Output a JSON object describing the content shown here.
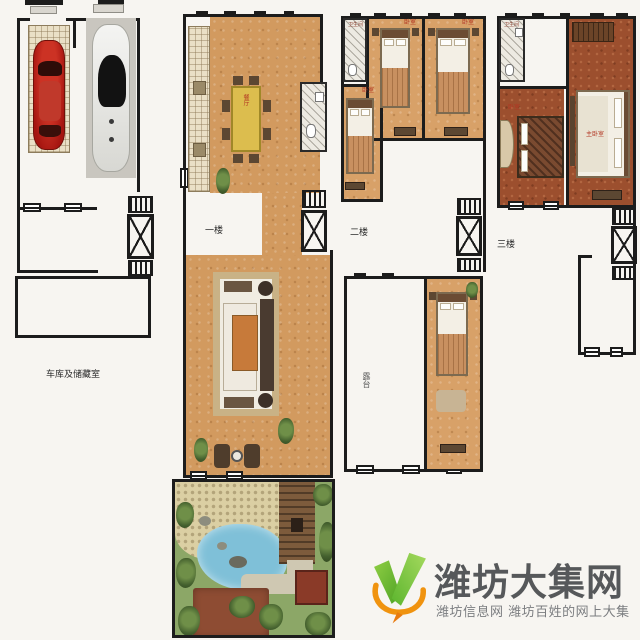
{
  "image_type": "multi-level villa floor plan (garage, 3 floors, garden) with site watermark",
  "plans": {
    "garage": {
      "name_label": "车库及储藏室"
    },
    "floor1": {
      "floor_label": "一楼",
      "dining_label": "餐厅"
    },
    "floor2": {
      "floor_label": "二楼",
      "bath_label": "卫生间",
      "bedroom_label_1": "卧室",
      "bedroom_label_2": "卧室",
      "bedroom_label_3": "卧室",
      "terrace_label": "露台"
    },
    "floor3": {
      "floor_label": "三楼",
      "bath_label": "卫生间",
      "master_label": "主卧室",
      "bedroom_label": "卧室"
    }
  },
  "watermark": {
    "site_name": "潍坊大集网",
    "tagline": "潍坊信息网 潍坊百姓的网上大集"
  },
  "colors": {
    "wall": "#1c1c1c",
    "floor_tan": "#d29a5f",
    "floor_dark": "#9c4f2e",
    "table_yellow": "#dcbd4e",
    "lawn": "#8ca767",
    "pond": "#7fc0d8",
    "stone": "#dbcfa3",
    "deck": "#7d5b3c",
    "patio_red": "#8e4c33",
    "logo_green": "#6ab82e",
    "logo_orange": "#f0930f",
    "title_gray": "#56585a",
    "subtitle_gray": "#7b7d80"
  }
}
